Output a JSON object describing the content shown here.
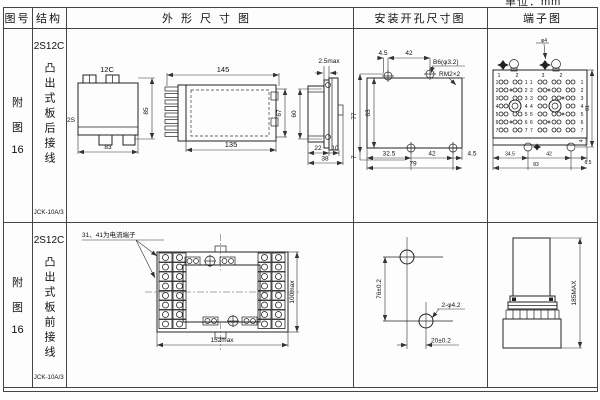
{
  "page": {
    "unit": "单位：mm"
  },
  "header": {
    "fig_no": "图号",
    "structure": "结构",
    "outline": "外形尺寸图",
    "mounting": "安装开孔尺寸图",
    "terminal": "端子图"
  },
  "rows": [
    {
      "fig": [
        "附",
        "图",
        "16"
      ],
      "model": "2S12C",
      "mount_type": "凸出式板后接线",
      "relay_type": "JCK-10A/3",
      "outline": {
        "top_label": "12C",
        "case_label": "2S",
        "height": "85",
        "width": "83",
        "side_top": "145",
        "side_bottom": "135",
        "side_height": "67",
        "panel_gap": "2.5max",
        "panel_height": "60",
        "panel_d1": "22",
        "panel_d2": "10",
        "panel_total": "38"
      },
      "mounting": {
        "t1": "4.5",
        "t2": "42",
        "hole_callout": "B6(φ3.2)",
        "stud_callout": "RM2×2",
        "left_total": "77",
        "left_inner": "63",
        "b0": "7",
        "b1": "32.5",
        "b2": "42",
        "b3": "4.5",
        "b_total": "79"
      },
      "terminal": {
        "screw_callout": "φ4",
        "col_marks": [
          "1",
          "2",
          "3",
          "2"
        ],
        "rows_left": [
          "1",
          "2",
          "3",
          "4",
          "5",
          "6",
          "7"
        ],
        "rows_right": [
          "1",
          "2",
          "3",
          "4",
          "5",
          "6",
          "7"
        ],
        "center": [
          "11",
          "22",
          "33",
          "44",
          "55",
          "66",
          "77"
        ],
        "b1": "34.5",
        "b2": "42",
        "b3": "6.5",
        "b_total": "83",
        "right_h": "81",
        "stud_drop": "4"
      }
    },
    {
      "fig": [
        "附",
        "图",
        "16"
      ],
      "model": "2S12C",
      "mount_type": "凸出式板前接线",
      "relay_type": "JCK-10A/3",
      "note": "31、41为电流端子",
      "outline": {
        "width": "152max",
        "height": "100max"
      },
      "mounting": {
        "v": "76±0.2",
        "hole_callout": "2-φ4.2",
        "h": "20±0.2"
      },
      "terminal": {
        "height": "185MAX"
      }
    }
  ]
}
